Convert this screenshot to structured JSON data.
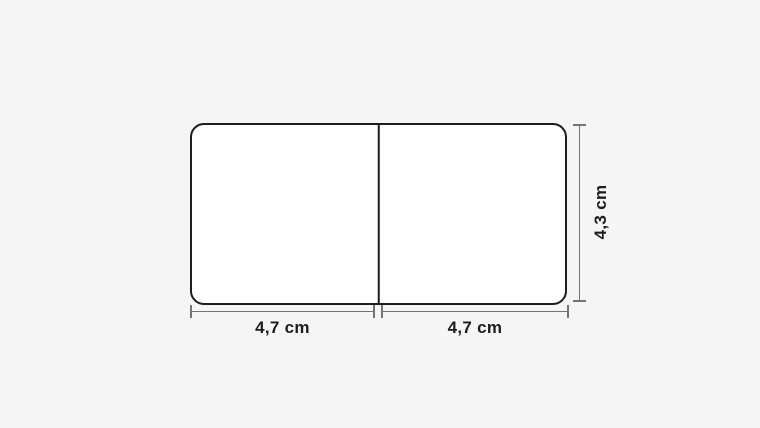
{
  "diagram": {
    "dimension_labels": {
      "left_width": "4,7 cm",
      "right_width": "4,7 cm",
      "height": "4,3 cm"
    },
    "colors": {
      "canvas_background": "#f5f5f6",
      "shape_outline": "#1d1d1b",
      "shape_fill": "#ffffff",
      "dimension_line": "#747474",
      "label_text": "#1d1d1b"
    }
  }
}
